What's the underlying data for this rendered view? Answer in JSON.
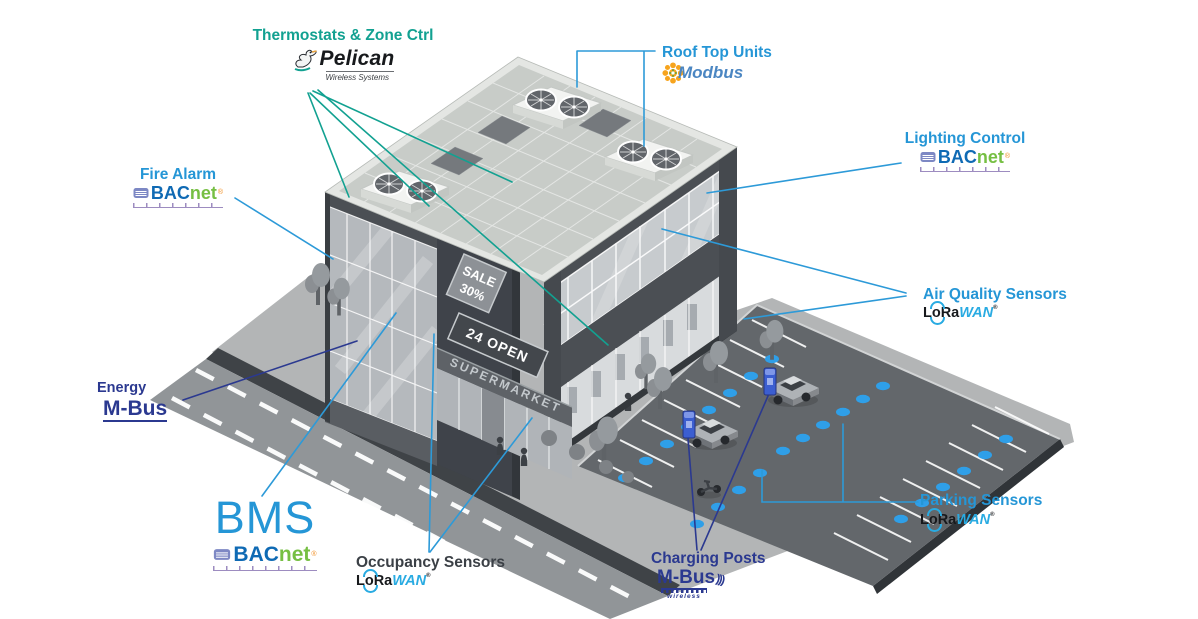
{
  "colors": {
    "teal": "#12a191",
    "light_blue": "#2596d6",
    "navy": "#2b3990",
    "lora_blue": "#29abe2",
    "bacnet_blue": "#0f6ab4",
    "bacnet_green": "#76bf43",
    "modbus_orange": "#f7a41d",
    "modbus_blue": "#4b86c2",
    "sensor_blue": "#2f9fe8",
    "text_dark": "#3b4046"
  },
  "labels": {
    "thermostats": {
      "title": "Thermostats & Zone Ctrl"
    },
    "rooftop": {
      "title": "Roof Top Units"
    },
    "fire_alarm": {
      "title": "Fire Alarm"
    },
    "lighting": {
      "title": "Lighting Control"
    },
    "air_quality": {
      "title": "Air Quality Sensors"
    },
    "energy": {
      "title": "Energy"
    },
    "bms": {
      "title": "BMS"
    },
    "occupancy": {
      "title": "Occupancy Sensors"
    },
    "charging": {
      "title": "Charging Posts"
    },
    "parking": {
      "title": "Parking Sensors"
    }
  },
  "logos": {
    "pelican": {
      "name": "Pelican",
      "tagline": "Wireless Systems"
    },
    "modbus": {
      "name": "Modbus"
    },
    "bacnet": {
      "bac": "BAC",
      "net": "net",
      "reg": "®"
    },
    "lorawan": {
      "lora": "LoRa",
      "wan": "WAN",
      "reg": "®"
    },
    "mbus": {
      "name": "M-Bus"
    },
    "mbus_wireless": {
      "name": "M-Bus",
      "sub": "wireless",
      "waves": ")))"
    }
  },
  "building": {
    "signs": {
      "sale_line1": "SALE",
      "sale_line2": "30%",
      "open": "24 OPEN",
      "storefront": "SUPERMARKET"
    }
  }
}
